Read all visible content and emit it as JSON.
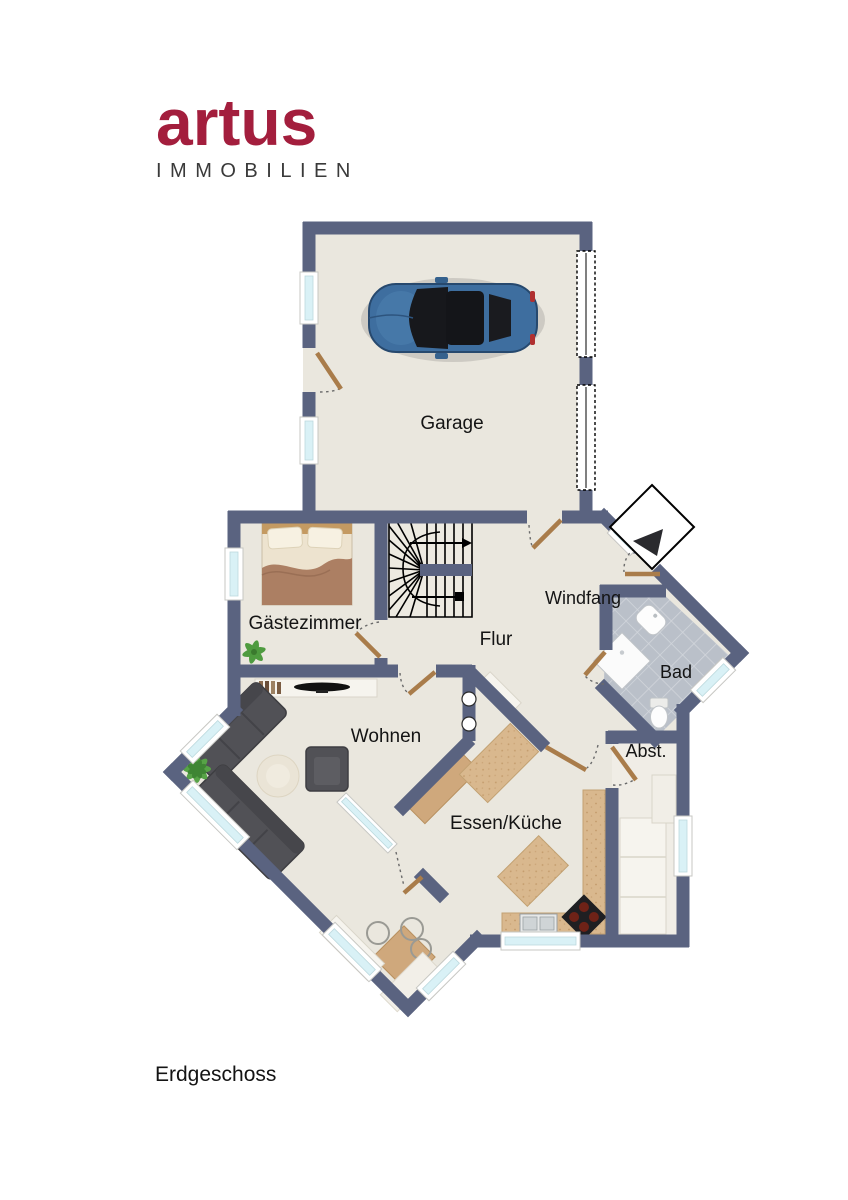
{
  "brand": {
    "name": "artus",
    "subtitle": "IMMOBILIEN",
    "color": "#a31e3d"
  },
  "plan_title": "Erdgeschoss",
  "rooms": {
    "garage": {
      "label": "Garage"
    },
    "gaestezimmer": {
      "label": "Gästezimmer"
    },
    "flur": {
      "label": "Flur"
    },
    "windfang": {
      "label": "Windfang"
    },
    "bad": {
      "label": "Bad"
    },
    "wohnen": {
      "label": "Wohnen"
    },
    "essen_kueche": {
      "label": "Essen/Küche"
    },
    "abstellraum": {
      "label": "Abst."
    }
  },
  "colors": {
    "wall": "#5a6380",
    "floor": "#eae7de",
    "bath_tile": "#bac0c9",
    "window_glass": "#d9f1f6",
    "door_wood": "#a97c4a",
    "car_blue": "#3e6e9f",
    "brand_red": "#a31e3d"
  }
}
